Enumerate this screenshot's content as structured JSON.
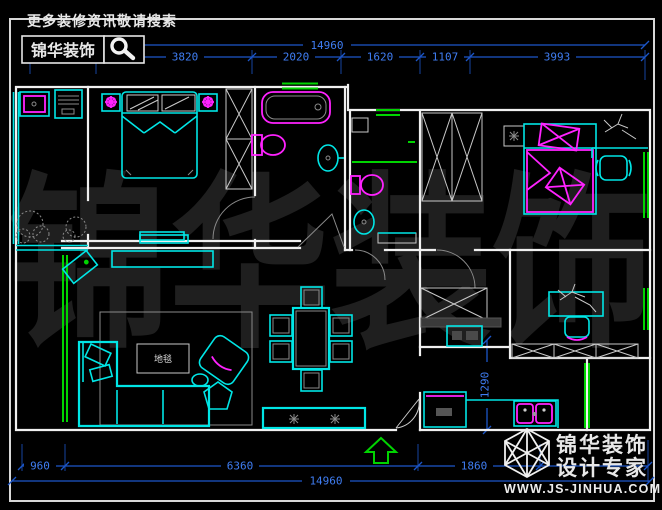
{
  "header": {
    "tagline": "更多装修资讯敬请搜索",
    "brand": "锦华装饰",
    "search_icon": "magnifier"
  },
  "dims": {
    "top_total": "14960",
    "top_segments": [
      "1560",
      "3820",
      "2020",
      "1620",
      "1107",
      "3993"
    ],
    "bottom_segments": [
      "960",
      "6360",
      "1860"
    ],
    "bottom_total": "14960",
    "kitchen_vertical": "1290"
  },
  "labels": {
    "coffee_table": "地毯"
  },
  "watermark": {
    "text": "锦华装饰"
  },
  "footer_logo": {
    "brand": "锦华装饰",
    "subtitle": "设计专家",
    "website": "WWW.JS-JINHUA.COM",
    "icon": "wireframe-cube"
  },
  "colors": {
    "background": "#000000",
    "wall_white": "#f0f0f0",
    "furniture_cyan": "#00e6e6",
    "fixture_magenta": "#ff22ff",
    "window_green": "#00d400",
    "dimension_line_blue": "#1c56c9",
    "dimension_text_blue": "#3f7df2",
    "watermark_gray": "#1f1f1f"
  }
}
